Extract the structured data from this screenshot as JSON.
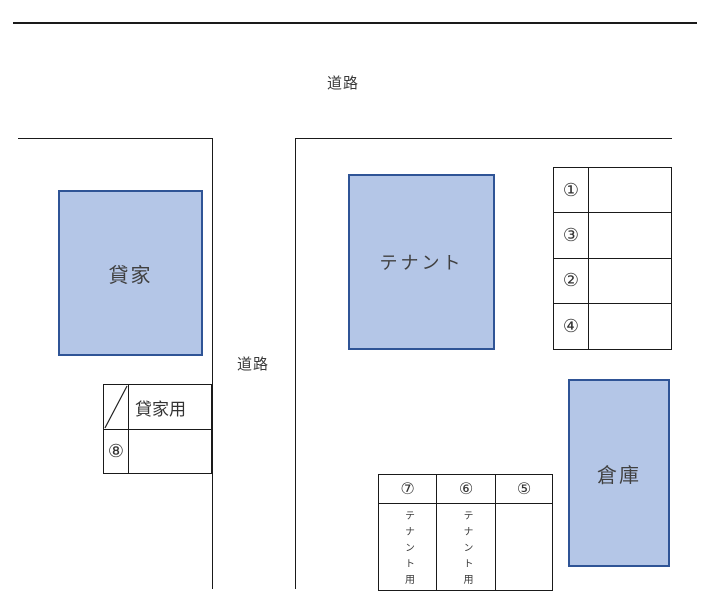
{
  "road_labels": {
    "top": "道路",
    "middle": "道路"
  },
  "buildings": {
    "rental_house": "貸家",
    "tenant": "テナント",
    "warehouse": "倉庫"
  },
  "rental_parking_table": {
    "use_label": "貸家用",
    "space_number": "⑧"
  },
  "numbered_parking_table": {
    "spaces": [
      "①",
      "③",
      "②",
      "④"
    ]
  },
  "tenant_parking_table": {
    "headers": [
      "⑦",
      "⑥",
      "⑤"
    ],
    "uses": [
      "テナント用",
      "テナント用",
      ""
    ]
  },
  "colors": {
    "building_fill": "#b4c6e7",
    "building_border": "#2f5496",
    "line": "#1a1a1a",
    "background": "#ffffff"
  }
}
